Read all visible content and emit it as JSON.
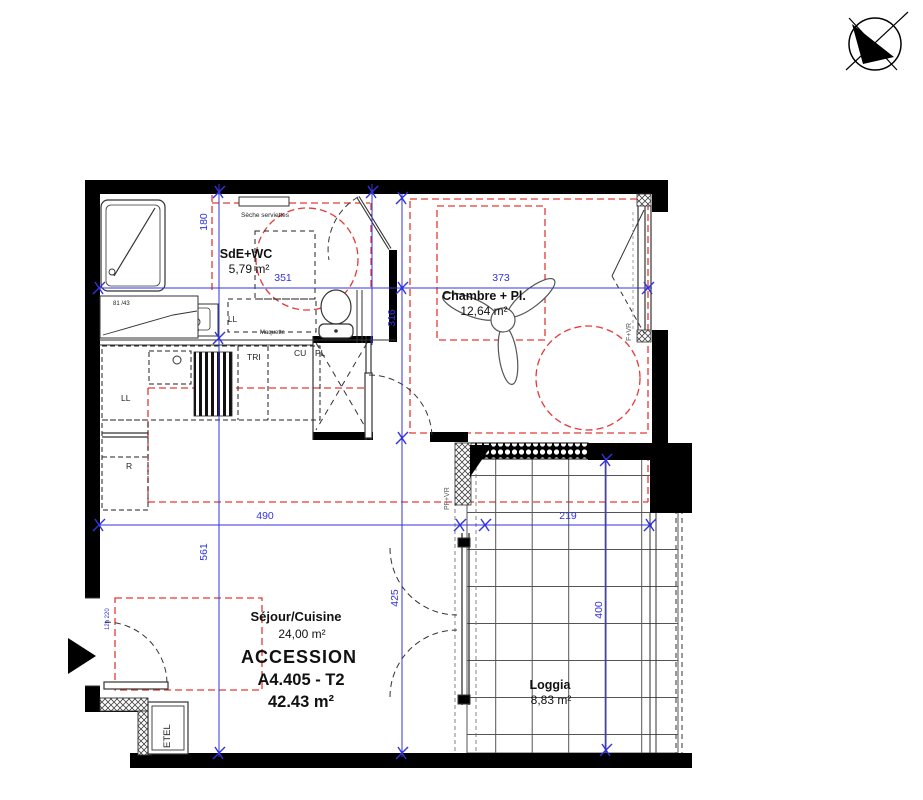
{
  "plan": {
    "unit": {
      "program": "ACCESSION",
      "ref": "A4.405 - T2",
      "area": "42.43 m²"
    },
    "rooms": {
      "bathroom": {
        "name": "SdE+WC",
        "area": "5,79 m²"
      },
      "bedroom": {
        "name": "Chambre + Pl.",
        "area": "12,64 m²"
      },
      "living": {
        "name": "Séjour/Cuisine",
        "area": "24,00 m²"
      },
      "loggia": {
        "name": "Loggia",
        "area": "8,83 m²"
      }
    },
    "dimensions": {
      "bath_depth": "180",
      "bath_width": "351",
      "bed_width": "373",
      "bed_depth": "316",
      "living_width": "490",
      "living_depth": "561",
      "loggia_width": "219",
      "door_span": "425",
      "loggia_depth": "400"
    },
    "labels": {
      "towel_dryer": "Sèche serviettes",
      "maquette": "Maquette",
      "left_window": "81 /43",
      "washer_bath": "LL",
      "washer": "LL",
      "fridge": "R",
      "sorting": "TRI",
      "kitchen_unit": "CU",
      "closet": "PL",
      "etel": "ETEL",
      "french_door": "PF+VR",
      "bedroom_window": "F+VR",
      "entry_door_tag": "12h 220"
    },
    "colors": {
      "wall": "#000000",
      "dimension": "#3333dd",
      "clearance": "#e53935"
    }
  }
}
